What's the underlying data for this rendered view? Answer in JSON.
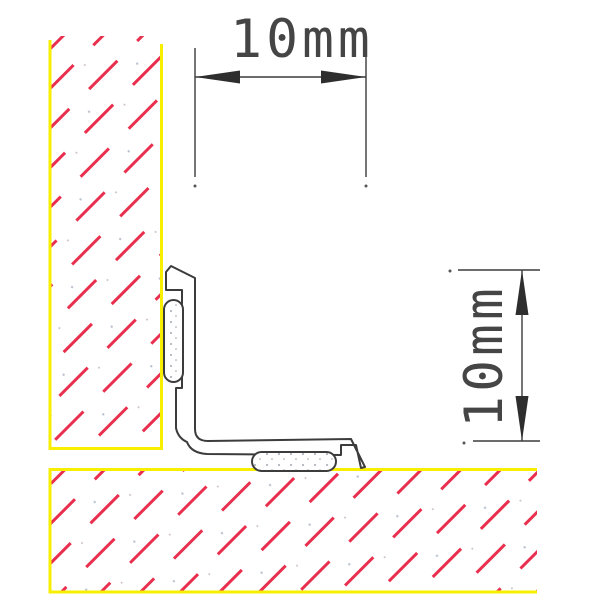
{
  "drawing": {
    "dimension_top": {
      "label": "10mm",
      "value_mm": 10,
      "orientation": "horizontal"
    },
    "dimension_right": {
      "label": "10mm",
      "value_mm": 10,
      "orientation": "vertical"
    },
    "colors": {
      "hatch_red": "#e8304e",
      "surface_yellow": "#f7ee00",
      "line_dark": "#3c3c3c",
      "arrow_dark": "#2e2e2e",
      "text_gray": "#454545",
      "stipple_gray": "#848e9a",
      "background": "#ffffff"
    },
    "shapes": {
      "wall_section": "hatched-wall-left",
      "floor_section": "hatched-floor-bottom",
      "trim_profile": "l-shaped-corner-trim",
      "pad_vertical": "adhesive-pad-wall-side",
      "pad_horizontal": "adhesive-pad-floor-side"
    }
  }
}
